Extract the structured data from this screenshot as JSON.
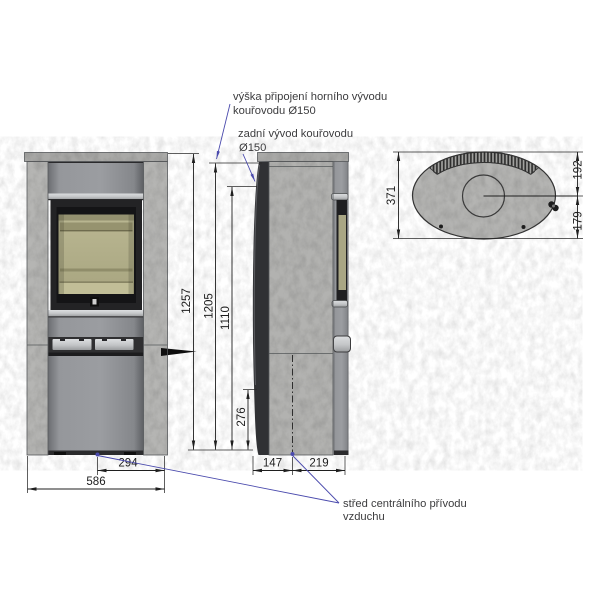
{
  "drawing": {
    "type": "technical drawing",
    "subject": "stone-clad wood stove — front, side and top views with dimensions"
  },
  "callouts": {
    "top_outlet_1": "výška připojení horního vývodu",
    "top_outlet_2": "kouřovodu Ø150",
    "rear_outlet_1": "zadní vývod kouřovodu",
    "rear_outlet_2": "Ø150",
    "air_supply_1": "střed centrálního přívodu",
    "air_supply_2": "vzduchu"
  },
  "dims": {
    "height_total": "1257",
    "height_top_outlet": "1205",
    "height_rear_outlet": "1110",
    "height_rear_air": "276",
    "air_center_to_edge": "294",
    "width_total": "586",
    "back_to_air_center": "147",
    "air_center_to_front": "219",
    "depth_total": "371",
    "top_front_to_flue": "192",
    "flue_to_back": "179"
  },
  "colors": {
    "callout_blue": "#4a4aad",
    "dim_line": "#1f1f1f",
    "stone": "#b5b5b3",
    "metal": "#919397",
    "glass": "#b2ae88",
    "door_frame": "#1e1e20"
  }
}
